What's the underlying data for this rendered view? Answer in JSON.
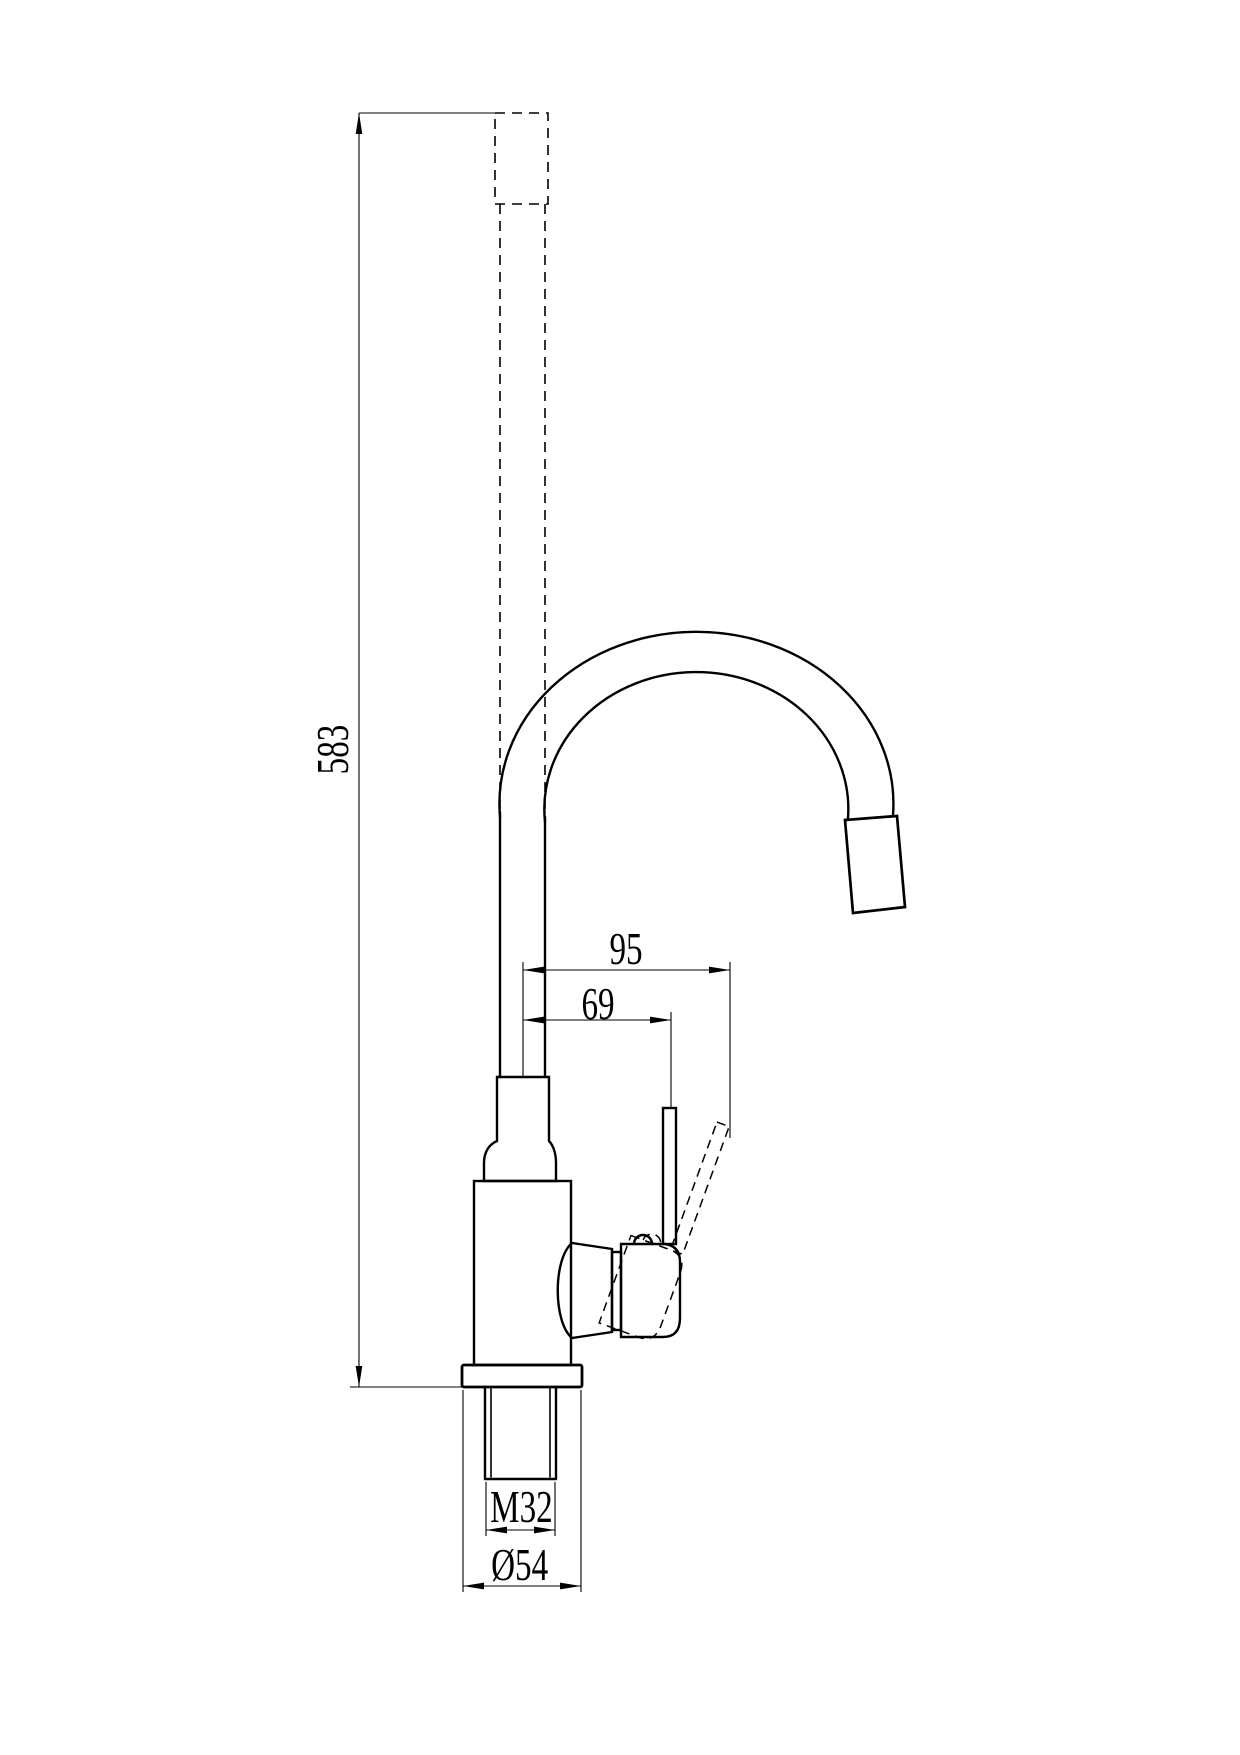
{
  "drawing": {
    "labels": {
      "overall_height": "583",
      "spout_reach": "95",
      "handle_offset": "69",
      "thread_size": "M32",
      "base_diameter": "Ø54"
    },
    "colors": {
      "line": "#000000",
      "background": "#ffffff"
    }
  }
}
